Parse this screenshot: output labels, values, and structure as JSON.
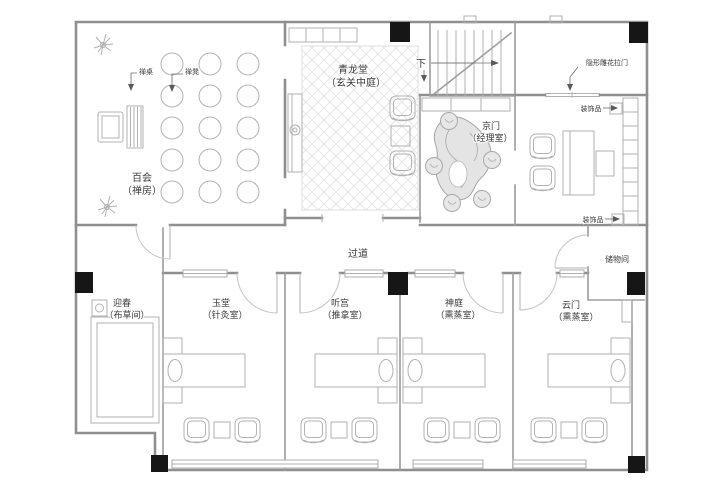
{
  "colors": {
    "background": "#ffffff",
    "wall_line": "#8f8f8f",
    "furniture_line": "#b2b2b2",
    "column_fill": "#161616",
    "label_text": "#3a3a3a",
    "floor_pattern": "#e2e2e2"
  },
  "rooms": {
    "baihui": {
      "name": "百会",
      "type": "（禅房）"
    },
    "qinglongtang": {
      "name": "青龙堂",
      "type": "（玄关中庭）"
    },
    "jingmen": {
      "name": "京门",
      "type": "（经理室）"
    },
    "yingchun": {
      "name": "迎春",
      "type": "（布草间）"
    },
    "yutang": {
      "name": "玉堂",
      "type": "（针灸室）"
    },
    "tinggong": {
      "name": "听宫",
      "type": "（推拿室）"
    },
    "shenting": {
      "name": "神庭",
      "type": "（熏蒸室）"
    },
    "yunmen": {
      "name": "云门",
      "type": "（熏蒸室）"
    },
    "chuwujian": {
      "name": "储物间",
      "type": ""
    },
    "guodao": {
      "name": "过道",
      "type": ""
    }
  },
  "annotations": {
    "chan_table": "禅桌",
    "chan_stool": "禅凳",
    "stair_down": "下",
    "hidden_carved_sliding_door": "隐形雕花拉门",
    "decor_item_top": "装饰品",
    "decor_item_bottom": "装饰品"
  }
}
